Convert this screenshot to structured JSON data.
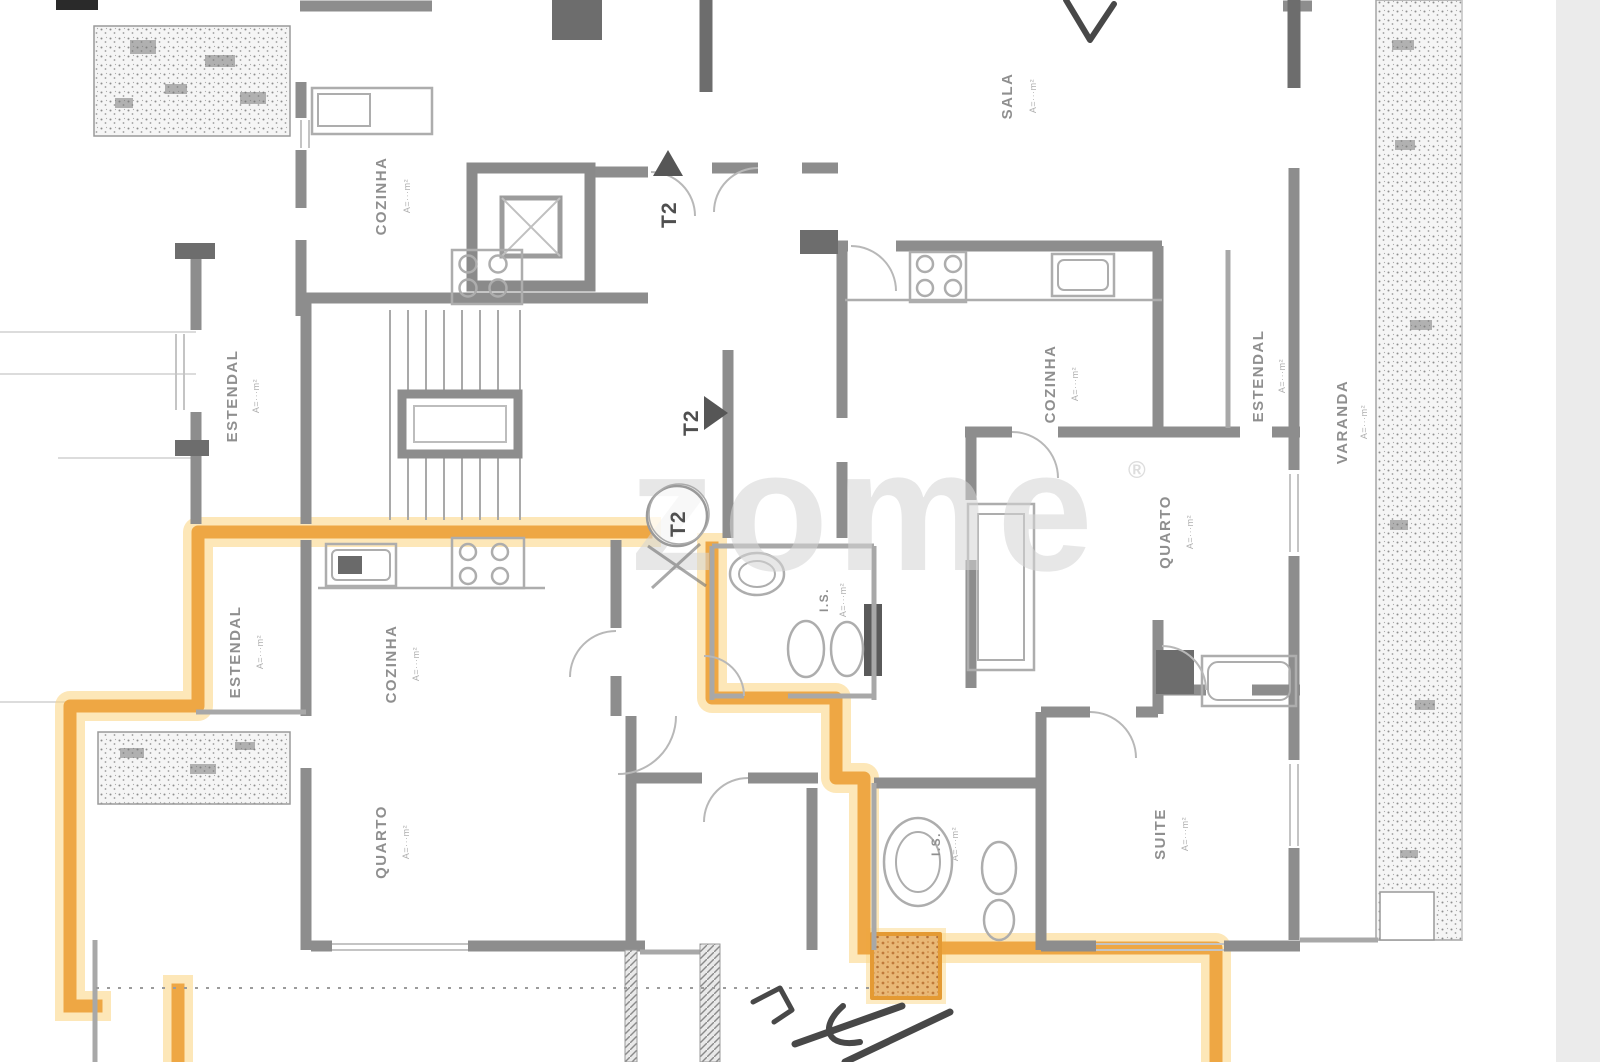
{
  "scan": {
    "paper_color": "#ffffff",
    "edge_band_color": "#ebebeb"
  },
  "watermark": {
    "text": "zome",
    "mark": "®"
  },
  "markers": {
    "t2": "T2"
  },
  "highlight": {
    "color": "#eda23a",
    "glow": "#fbd788"
  },
  "rooms": [
    {
      "name": "COZINHA",
      "area": "A=···m²"
    },
    {
      "name": "ESTENDAL",
      "area": "A=···m²"
    },
    {
      "name": "SALA",
      "area": "A=···m²"
    },
    {
      "name": "COZINHA",
      "area": "A=···m²"
    },
    {
      "name": "ESTENDAL",
      "area": "A=···m²"
    },
    {
      "name": "VARANDA",
      "area": "A=···m²"
    },
    {
      "name": "QUARTO",
      "area": "A=···m²"
    },
    {
      "name": "ESTENDAL",
      "area": "A=···m²"
    },
    {
      "name": "COZINHA",
      "area": "A=···m²"
    },
    {
      "name": "I.S.",
      "area": "A=···m²"
    },
    {
      "name": "QUARTO",
      "area": "A=···m²"
    },
    {
      "name": "SUITE",
      "area": "A=···m²"
    },
    {
      "name": "I.S.",
      "area": "A=···m²"
    }
  ]
}
